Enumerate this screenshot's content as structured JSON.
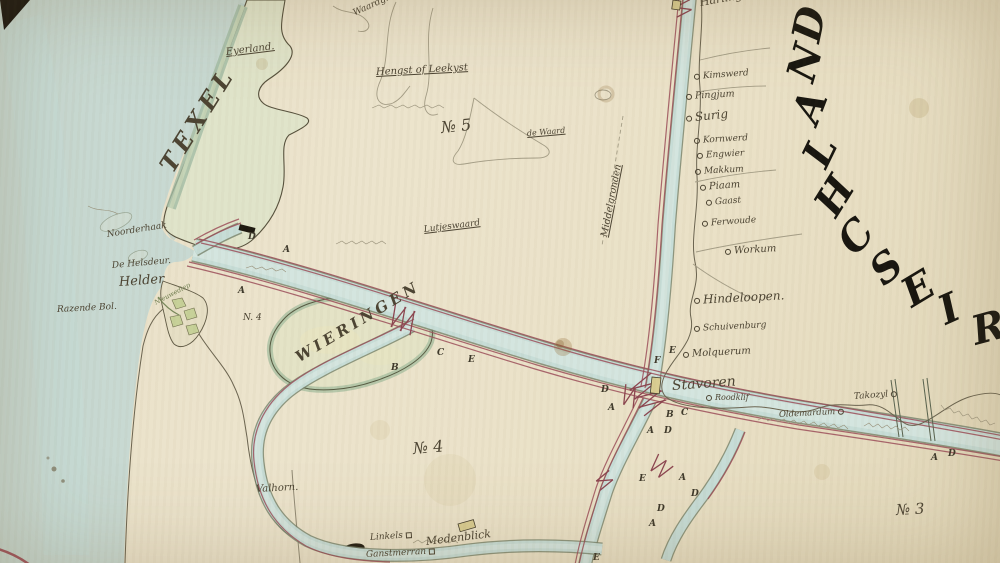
{
  "regions": {
    "texel": "TEXEL",
    "wieringen": "WIERINGEN",
    "vriesland_letters": [
      "R",
      "I",
      "E",
      "S",
      "C",
      "H",
      "L",
      "A",
      "N",
      "D"
    ]
  },
  "labels": {
    "waardgronden": "Waardgronden",
    "eyerland": "Eyerland.",
    "hengst": "Hengst of Leekyst",
    "no5": "№ 5",
    "de_waard": "de Waard",
    "middelgronden": "Middelgronden",
    "lutjeswaard": "Lutjeswaard",
    "noorderhaak": "Noorderhaak",
    "helsdeur": "De Helsdeur.",
    "helder": "Helder",
    "razende_bol": "Razende Bol.",
    "nieuwediep": "Nieuwediep",
    "harlingen": "Harlingen",
    "stavoren": "Stavoren",
    "roodklif": "Roodklif",
    "takozyl": "Takozyl",
    "oldemardum": "Oldemardum",
    "medenblick": "Medenblick",
    "valhorn": "Valhorn.",
    "linkels": "Linkels",
    "ganstmerran": "Ganstmerran",
    "no4": "№ 4",
    "n4_small": "N. 4",
    "no3": "№ 3"
  },
  "villages": [
    {
      "name": "Kimswerd"
    },
    {
      "name": "Pingjum"
    },
    {
      "name": "Surig"
    },
    {
      "name": "Kornwerd"
    },
    {
      "name": "Engwier"
    },
    {
      "name": "Makkum"
    },
    {
      "name": "Piaam"
    },
    {
      "name": "Gaast"
    },
    {
      "name": "Ferwoude"
    },
    {
      "name": "Workum"
    },
    {
      "name": "Hindeloopen."
    },
    {
      "name": "Schuivenburg"
    },
    {
      "name": "Molquerum"
    }
  ],
  "dike_letters": [
    "D",
    "A",
    "A",
    "B",
    "C",
    "E",
    "F",
    "E",
    "D",
    "A",
    "B",
    "C",
    "A",
    "D",
    "E",
    "A",
    "D",
    "D",
    "A",
    "E",
    "A",
    "D"
  ]
}
